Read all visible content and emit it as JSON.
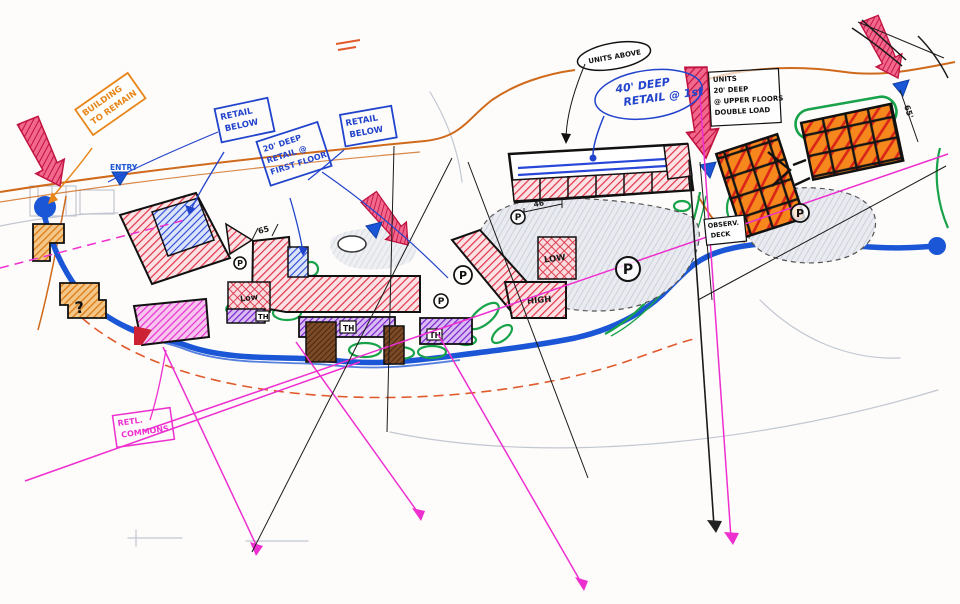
{
  "scene": {
    "description": "Hand-drawn architectural master-plan marker sketch with annotated retail, unit and parking areas"
  },
  "colors": {
    "paper": "#fdfcfa",
    "red_marker": "#e23348",
    "crimson_arrow": "#c01040",
    "orange_marker": "#e8861a",
    "blue_ink": "#2244cc",
    "road_blue": "#1b56d6",
    "magenta": "#ee2fd0",
    "purple": "#7a1fd0",
    "green": "#18a24a",
    "brown": "#7c4a26",
    "pencil_gray": "#c2c7d2",
    "black_ink": "#1a1a1a"
  },
  "labels": {
    "building_to_remain": [
      "BUILDING",
      "TO REMAIN"
    ],
    "entry": "ENTRY",
    "retail_below": [
      "RETAIL",
      "BELOW"
    ],
    "retail_20_deep": [
      "20' DEEP",
      "RETAIL @",
      "FIRST FLOOR"
    ],
    "units_above": "UNITS ABOVE",
    "retail_40_deep": [
      "40' DEEP",
      "RETAIL @ 1st"
    ],
    "units_upper": [
      "UNITS",
      "20' DEEP",
      "@ UPPER FLOORS",
      "DOUBLE LOAD"
    ],
    "observation_deck": [
      "OBSERV.",
      "DECK"
    ],
    "retail_commons": [
      "RETL.",
      "COMMONS"
    ],
    "high": "HIGH",
    "low": "LOW",
    "low_mixed": "Low",
    "townhouse": "TH",
    "parking": "P",
    "question": "?",
    "dim_65": "65",
    "dim_46": "46'",
    "dim_65_right": "65'"
  }
}
